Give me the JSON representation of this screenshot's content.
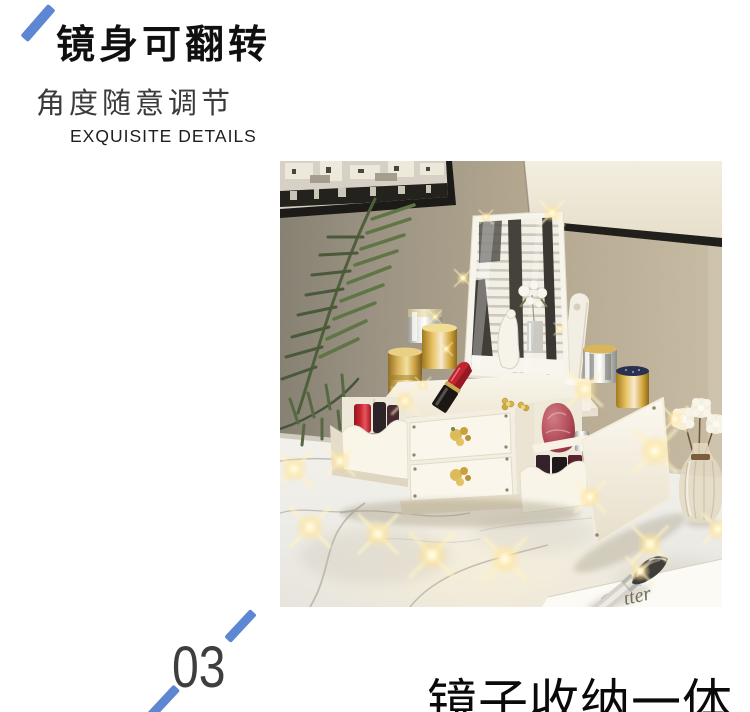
{
  "accent_color": "#5d86d3",
  "feature_header": {
    "title": "镜身可翻转",
    "subtitle": "角度随意调节",
    "caption_en": "EXQUISITE DETAILS"
  },
  "section_footer": {
    "number": "03",
    "next_section_title": "镜子收纳一体"
  },
  "product_photo": {
    "card_text": "tter"
  }
}
